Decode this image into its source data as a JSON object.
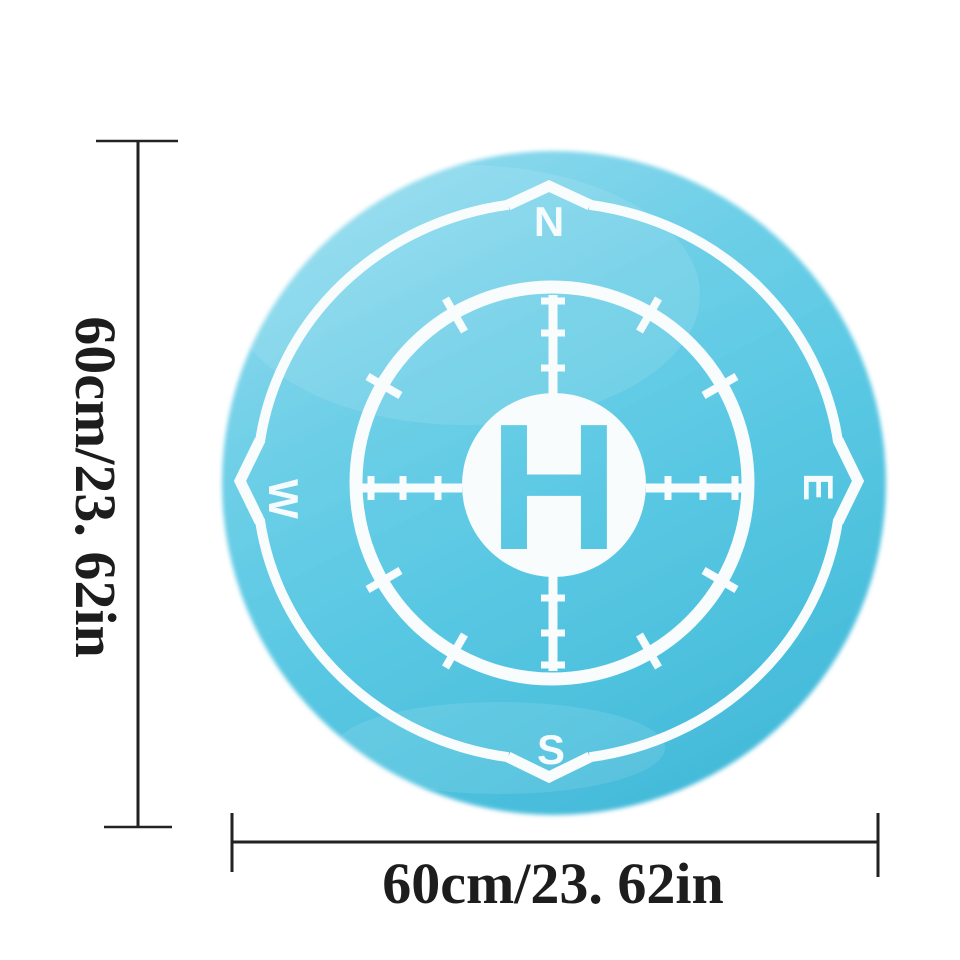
{
  "pad": {
    "center_marking": "H",
    "compass": {
      "north": "N",
      "east": "E",
      "south": "S",
      "west": "W"
    },
    "colors": {
      "pad_blue_light": "#93dbee",
      "pad_blue_mid": "#5ac8e3",
      "pad_blue_dark": "#3fb6d7",
      "marking_white": "#f8fcfd",
      "h_letter_blue": "#58c8e2",
      "dimension_line_black": "#222222",
      "background": "#ffffff"
    }
  },
  "dimensions": {
    "height_label": "60cm/23. 62in",
    "width_label": "60cm/23. 62in"
  }
}
